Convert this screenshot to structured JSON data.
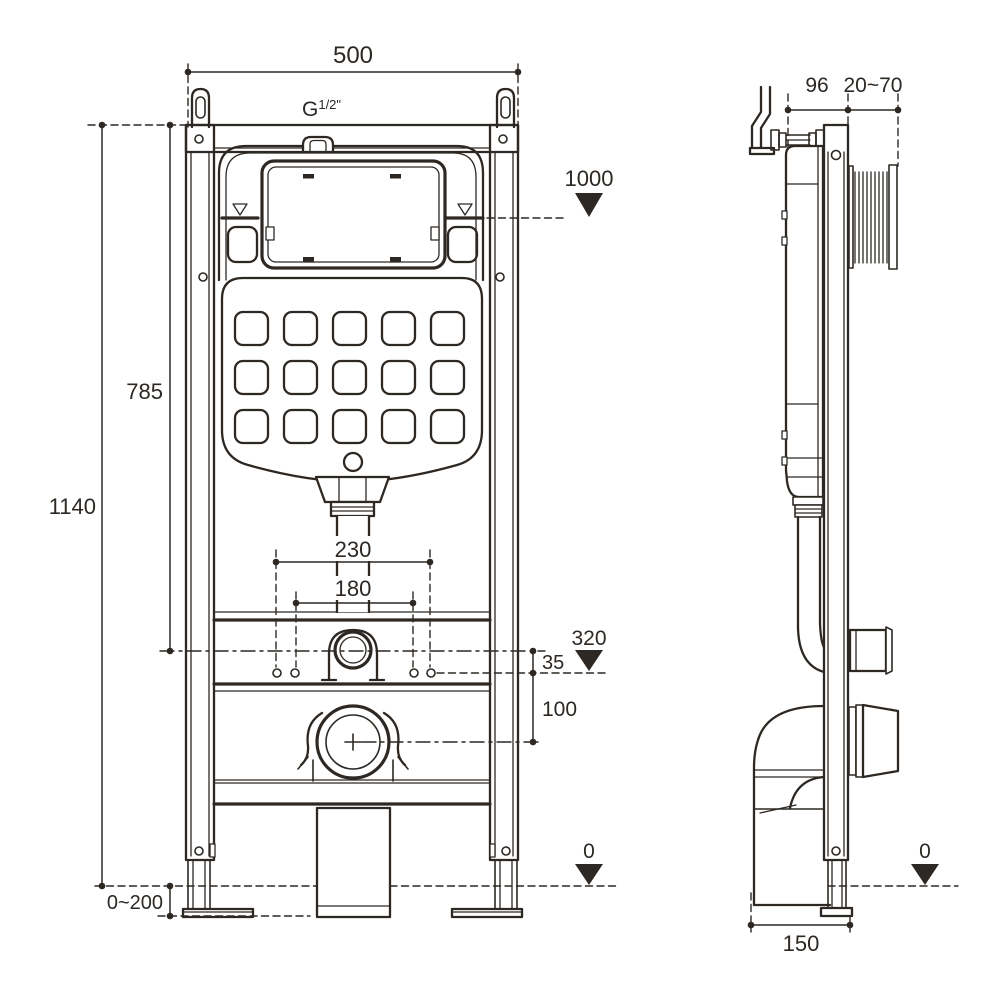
{
  "drawing": {
    "type": "installation-dimension-drawing",
    "subject": "concealed-cistern-wc-mounting-frame",
    "background_color": "#ffffff",
    "line_color": "#2d2823",
    "symbols": {
      "datum_marker": "filled-triangle-down",
      "water_level_marker": "open-triangle-down"
    }
  },
  "front_view": {
    "name": "front-view",
    "labels": {
      "width": "500",
      "thread_base": "G",
      "thread_sup": "1/2\"",
      "plate_height": "1000",
      "tank_height": "785",
      "frame_height": "1140",
      "pipe_spacing_outer": "230",
      "pipe_spacing_inner": "180",
      "outlet_datum": "320",
      "offset_top": "35",
      "offset_bottom": "100",
      "foot_adjust": "0~200",
      "floor_datum": "0"
    }
  },
  "side_view": {
    "name": "side-view",
    "labels": {
      "frame_depth": "96",
      "wall_distance": "20~70",
      "floor_datum": "0",
      "base_depth": "150"
    }
  }
}
